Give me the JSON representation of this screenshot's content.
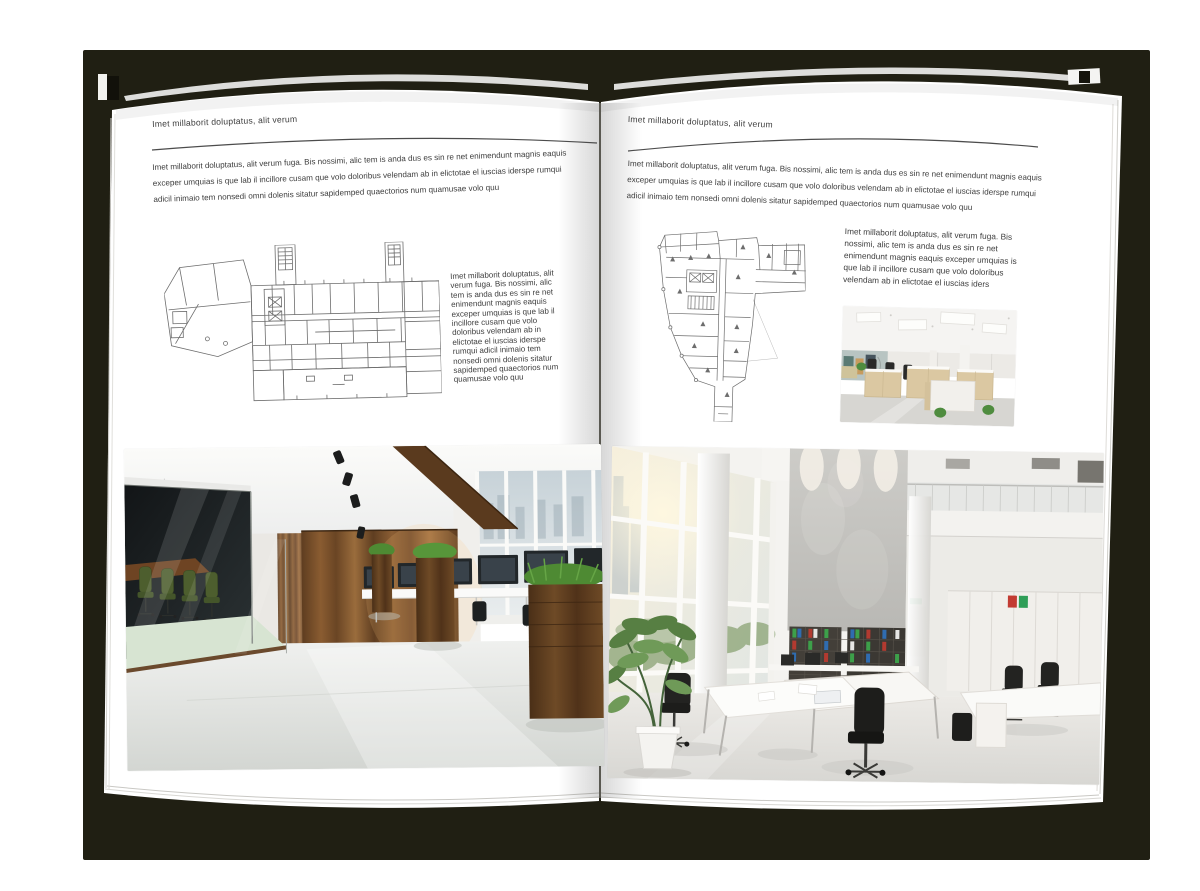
{
  "document": {
    "kind": "open-brochure-spread"
  },
  "colors": {
    "cover": "#201f13",
    "page": "#ffffff",
    "text": "#3d3d3d",
    "rule": "#4c4c4c"
  },
  "left_page": {
    "header": "Imet millaborit doluptatus, alit verum",
    "intro": "Imet millaborit doluptatus, alit verum fuga. Bis nossimi, alic tem is anda dus es sin re net enimendunt magnis eaquis exceper umquias is que lab il incillore cusam que volo doloribus velendam ab in elictotae el iuscias iderspe rumqui adicil inimaio tem nonsedi omni dolenis sitatur sapidemped quaectorios num quamusae volo quu",
    "side_text": "Imet millaborit doluptatus, alit verum fuga. Bis nossimi, alic tem is anda dus es sin re net enimendunt magnis eaquis exceper umquias is que lab il incillore cusam que volo doloribus velendam ab in elictotae el iuscias iderspe rumqui adicil inimaio tem nonsedi omni dolenis sitatur sapidemped quaectorios num quamusae volo quu"
  },
  "right_page": {
    "header": "Imet millaborit doluptatus, alit verum",
    "intro": "Imet millaborit doluptatus, alit verum fuga. Bis nossimi, alic tem is anda dus es sin re net enimendunt magnis eaquis exceper umquias is que lab il incillore cusam que volo doloribus velendam ab in elictotae el iuscias iderspe rumqui adicil inimaio tem nonsedi omni dolenis sitatur sapidemped quaectorios num quamusae volo quu",
    "side_text": "Imet millaborit doluptatus, alit verum fuga. Bis nossimi, alic tem is anda dus es sin re net enimendunt magnis eaquis exceper umquias is que lab il incillore cusam que volo doloribus velendam ab in elictotae el iuscias iders"
  }
}
